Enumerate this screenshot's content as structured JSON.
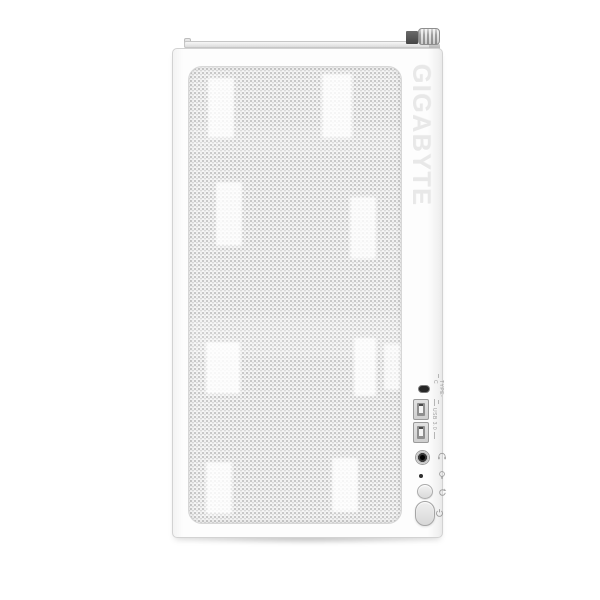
{
  "product": {
    "brand_text": "GIGABYTE",
    "description": "white mesh-front PC case, front view"
  },
  "colors": {
    "background": "#ffffff",
    "case_white": "#fdfdfd",
    "case_border": "#d2d2d2",
    "mesh_base": "#f1f1f1",
    "mesh_dot": "#bdbdbd",
    "brand_gray": "#e8e8e8",
    "label_gray": "#9a9a9a",
    "port_dark": "#262626"
  },
  "io_panel": {
    "rows": [
      {
        "name": "type-c-port",
        "label": "TYPE-C"
      },
      {
        "name": "usb-a-ports",
        "label": "USB 3.0",
        "count": 2
      },
      {
        "name": "audio-jack",
        "icon": "headphone-icon"
      },
      {
        "name": "indicator-pinhole",
        "icon": "bulb-icon"
      },
      {
        "name": "reset-button",
        "icon": "reset-icon"
      },
      {
        "name": "power-button",
        "icon": "power-icon"
      }
    ]
  },
  "hardware": {
    "top_parts": [
      "top-rail",
      "thumbscrew"
    ]
  }
}
